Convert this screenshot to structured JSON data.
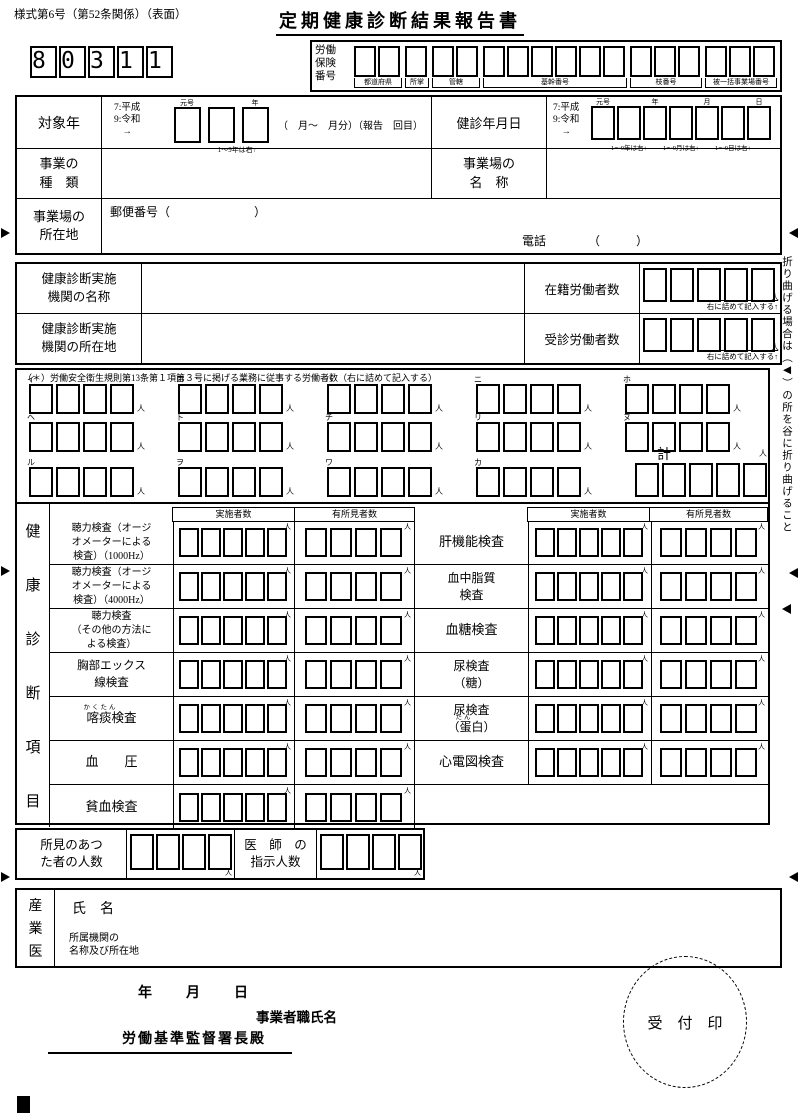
{
  "units": {
    "person": "人"
  },
  "header": {
    "style_number": "様式第6号（第52条関係）（表面）",
    "title": "定期健康診断結果報告書",
    "code_digits": [
      "8",
      "0",
      "3",
      "1",
      "1"
    ]
  },
  "labor_insurance": {
    "label_lines": [
      "労働",
      "保険",
      "番号"
    ],
    "groups": [
      {
        "label": "都道府県",
        "boxes": 2
      },
      {
        "label": "所掌",
        "boxes": 1
      },
      {
        "label": "管轄",
        "boxes": 2
      },
      {
        "label": "基幹番号",
        "boxes": 6
      },
      {
        "label": "枝番号",
        "boxes": 3
      },
      {
        "label": "被一括事業場番号",
        "boxes": 3
      }
    ]
  },
  "target_year": {
    "label": "対象年",
    "era_lines": [
      "7:平成",
      "9:令和",
      "→"
    ],
    "col_era": "元号",
    "col_year": "年",
    "note": "1～9年は右↑",
    "suffix": "（　月～　月分）（報告　回目）"
  },
  "exam_date": {
    "label": "健診年月日",
    "era_lines": [
      "7:平成",
      "9:令和",
      "→"
    ],
    "cols": [
      "元号",
      "年",
      "月",
      "日"
    ],
    "notes": [
      "1～9年は右↑",
      "1～9月は右↑",
      "1～9日は右↑"
    ]
  },
  "business": {
    "type_label": [
      "事業の",
      "種　類"
    ],
    "name_label": [
      "事業場の",
      "名　称"
    ],
    "addr_label": [
      "事業場の",
      "所在地"
    ],
    "postal": "郵便番号（　　　　　　　）",
    "phone": "電話　　　　（　　　）"
  },
  "org": {
    "name_label": [
      "健康診断実施",
      "機関の名称"
    ],
    "addr_label": [
      "健康診断実施",
      "機関の所在地"
    ],
    "enrolled_label": "在籍労働者数",
    "examined_label": "受診労働者数",
    "fill_note": "右に詰めて記入する↑"
  },
  "special": {
    "note": "（＊）労働安全衛生規則第13条第１項第３号に掲げる業務に従事する労働者数（右に詰めて記入する）",
    "row1": [
      "イ",
      "ロ",
      "ハ",
      "ニ",
      "ホ"
    ],
    "row2": [
      "ヘ",
      "ト",
      "チ",
      "リ",
      "ヌ"
    ],
    "row3": [
      "ル",
      "ヲ",
      "ワ",
      "カ"
    ],
    "total_label": "計"
  },
  "checkup": {
    "vertical_label": [
      "健",
      "康",
      "診",
      "断",
      "項",
      "目"
    ],
    "header_done": "実施者数",
    "header_findings": "有所見者数",
    "left_items": [
      {
        "lines": [
          "聴力検査（オージ",
          "オメーターによる",
          "検査）（1000Hz）"
        ]
      },
      {
        "lines": [
          "聴力検査（オージ",
          "オメーターによる",
          "検査）（4000Hz）"
        ]
      },
      {
        "lines": [
          "聴力検査",
          "（その他の方法に",
          "よる検査）"
        ]
      },
      {
        "lines": [
          "胸部エックス",
          "線検査"
        ]
      },
      {
        "lines": [
          "喀痰検査"
        ],
        "furigana": "かくたん"
      },
      {
        "lines": [
          "血　　圧"
        ]
      },
      {
        "lines": [
          "貧血検査"
        ]
      }
    ],
    "right_items": [
      {
        "lines": [
          "肝機能検査"
        ]
      },
      {
        "lines": [
          "血中脂質",
          "検査"
        ]
      },
      {
        "lines": [
          "血糖検査"
        ]
      },
      {
        "lines": [
          "尿検査",
          "（糖）"
        ]
      },
      {
        "lines": [
          "尿検査",
          "（蛋白）"
        ],
        "furigana": "たん"
      },
      {
        "lines": [
          "心電図検査"
        ]
      }
    ]
  },
  "findings_row": {
    "label1": [
      "所見のあつ",
      "た者の人数"
    ],
    "label2": [
      "医　師　の",
      "指示人数"
    ]
  },
  "physician": {
    "vertical_label": [
      "産",
      "業",
      "医"
    ],
    "name_label": "氏　名",
    "org_label": [
      "所属機関の",
      "名称及び所在地"
    ]
  },
  "footer": {
    "date_line": "年　　月　　日",
    "employer": "事業者職氏名",
    "office": "労働基準監督署長殿",
    "seal": "受　付　印"
  },
  "fold": {
    "note": "折り曲げる場合は（◀）の所を谷に折り曲げること"
  }
}
